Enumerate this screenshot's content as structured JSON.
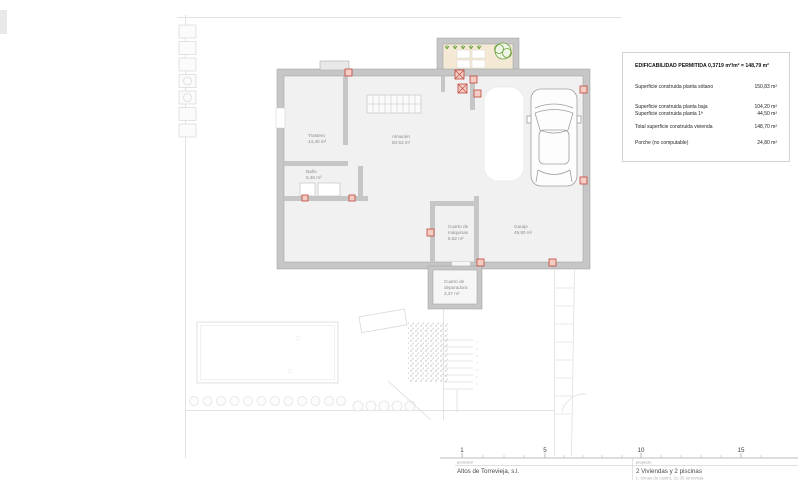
{
  "legend": {
    "title": "EDIFICABILIDAD PERMITIDA 0,3719 m²/m² = 148,79 m²",
    "rows": [
      {
        "label": "Superficie construida planta sótano",
        "value": "150,83 m²"
      },
      {
        "label": "Superficie construida planta baja",
        "value": "104,20 m²"
      },
      {
        "label": "Superficie construida planta 1ª",
        "value": "44,50 m²"
      },
      {
        "label": "Total superficie construida vivienda",
        "value": "148,70 m²"
      },
      {
        "label": "Porche (no computable)",
        "value": "24,80 m²"
      }
    ]
  },
  "rooms": {
    "trastero": {
      "name": "Trastero",
      "area": "14,40 m²"
    },
    "almacen": {
      "name": "Almacén",
      "area": "50,53 m²"
    },
    "bano": {
      "name": "Baño",
      "area": "5,48 m²"
    },
    "maquinas": {
      "name1": "Cuarto de",
      "name2": "máquinas",
      "area": "6,52 m²"
    },
    "garaje": {
      "name": "Garaje",
      "area": "49,80 m²"
    },
    "depuradora": {
      "name1": "Cuarto de",
      "name2": "depuradora",
      "area": "3,37 m²"
    }
  },
  "scalebar": {
    "labels": [
      "1",
      "5",
      "10",
      "15"
    ]
  },
  "titleblock": {
    "promoter_label": "promotor",
    "promoter_name": "Altos de Torrevieja, s.l.",
    "project_label": "proyecto",
    "project_name": "2 Viviendas y 2 piscinas",
    "project_address": "c. tomas de castro, 31-35 torrevieja"
  },
  "garden": {
    "stair_numbers": [
      "1",
      "2",
      "3",
      "4",
      "5",
      "6",
      "7"
    ]
  },
  "colors": {
    "wall_gray": "#c6c6c6",
    "column_red": "#c0453a",
    "porch_floor_tan": "#f3e9d4",
    "plant_green": "#6ba23c",
    "faint_line": "#e2e2e2"
  }
}
